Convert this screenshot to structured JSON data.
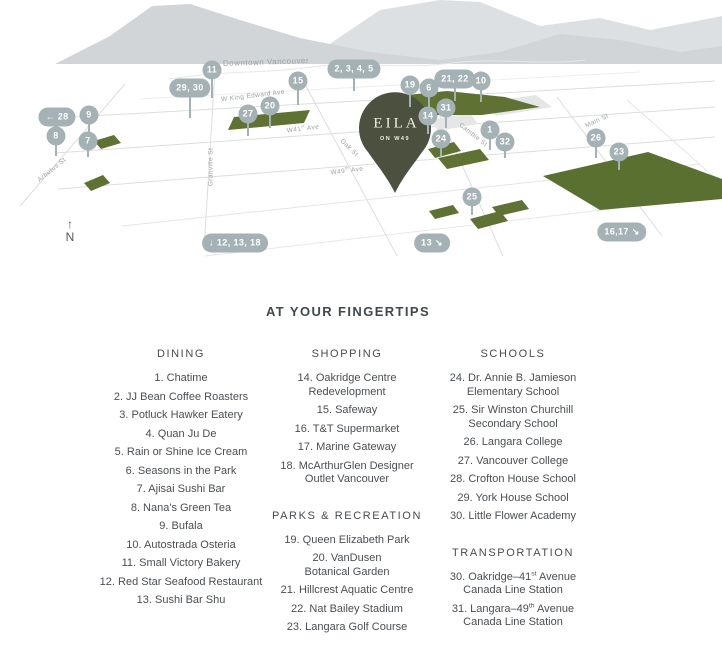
{
  "colors": {
    "marker": "#a4b2b6",
    "pin": "#4c503f",
    "pin_text": "#f0ede3",
    "park": "#5f7233",
    "golf": "#597031",
    "mountain": "#d1d5d7"
  },
  "map": {
    "pin": {
      "name": "EILA",
      "subtitle": "ON W49"
    },
    "north_arrow": "↑",
    "north_label": "N",
    "labels": [
      {
        "text": "Downtown Vancouver",
        "x": 266,
        "y": 62,
        "rot": -2,
        "big": true
      },
      {
        "text": "W King Edward Ave",
        "x": 253,
        "y": 96,
        "rot": -7
      },
      {
        "text": "W41st Ave",
        "x": 303,
        "y": 129,
        "rot": -7
      },
      {
        "text": "W49th Ave",
        "x": 347,
        "y": 171,
        "rot": -7
      },
      {
        "text": "Oak St",
        "x": 349,
        "y": 148,
        "rot": 44
      },
      {
        "text": "Cambie St",
        "x": 473,
        "y": 135,
        "rot": 38
      },
      {
        "text": "Main St",
        "x": 597,
        "y": 121,
        "rot": -26
      },
      {
        "text": "Granville St",
        "x": 211,
        "y": 167,
        "rot": -90
      },
      {
        "text": "Arbutus St",
        "x": 52,
        "y": 170,
        "rot": -39
      }
    ],
    "markers": [
      {
        "label": "11",
        "x": 212,
        "y": 70,
        "stem": 20
      },
      {
        "label": "29, 30",
        "x": 190,
        "y": 88,
        "stem": 22
      },
      {
        "label": "15",
        "x": 298,
        "y": 81,
        "stem": 16
      },
      {
        "label": "2, 3, 4, 5",
        "x": 354,
        "y": 69,
        "stem": 14
      },
      {
        "label": "19",
        "x": 410,
        "y": 85,
        "stem": 14
      },
      {
        "label": "6",
        "x": 429,
        "y": 88,
        "stem": 12
      },
      {
        "label": "21, 22",
        "x": 455,
        "y": 79,
        "stem": 14
      },
      {
        "label": "10",
        "x": 481,
        "y": 81,
        "stem": 13
      },
      {
        "label": "31",
        "x": 446,
        "y": 108,
        "stem": 12
      },
      {
        "label": "14",
        "x": 428,
        "y": 116,
        "stem": 10
      },
      {
        "label": "24",
        "x": 441,
        "y": 139,
        "stem": 9
      },
      {
        "label": "1",
        "x": 490,
        "y": 130,
        "stem": 12
      },
      {
        "label": "32",
        "x": 505,
        "y": 142,
        "stem": 8
      },
      {
        "label": "26",
        "x": 596,
        "y": 138,
        "stem": 12
      },
      {
        "label": "23",
        "x": 619,
        "y": 152,
        "stem": 10
      },
      {
        "label": "25",
        "x": 472,
        "y": 197,
        "stem": 10
      },
      {
        "label": "9",
        "x": 89,
        "y": 115,
        "stem": 12
      },
      {
        "label": "8",
        "x": 56,
        "y": 136,
        "stem": 12
      },
      {
        "label": "7",
        "x": 88,
        "y": 141,
        "stem": 8
      },
      {
        "label": "27",
        "x": 248,
        "y": 114,
        "stem": 14
      },
      {
        "label": "20",
        "x": 270,
        "y": 106,
        "stem": 14
      },
      {
        "label": "← 28",
        "x": 57,
        "y": 117,
        "stem": 0
      },
      {
        "label": "↓ 12, 13, 18",
        "x": 235,
        "y": 243,
        "stem": 0
      },
      {
        "label": "13 ↘",
        "x": 432,
        "y": 243,
        "stem": 0
      },
      {
        "label": "16,17 ↘",
        "x": 622,
        "y": 232,
        "stem": 0
      }
    ]
  },
  "legend": {
    "title": "AT YOUR FINGERTIPS",
    "columns": [
      {
        "sections": [
          {
            "title": "DINING",
            "items": [
              [
                "1.",
                "Chatime"
              ],
              [
                "2.",
                "JJ Bean Coffee Roasters"
              ],
              [
                "3.",
                "Potluck Hawker Eatery"
              ],
              [
                "4.",
                "Quan Ju De"
              ],
              [
                "5.",
                "Rain or Shine Ice Cream"
              ],
              [
                "6.",
                "Seasons in the Park"
              ],
              [
                "7.",
                "Ajisai Sushi Bar"
              ],
              [
                "8.",
                "Nana's Green Tea"
              ],
              [
                "9.",
                "Bufala"
              ],
              [
                "10.",
                "Autostrada Osteria"
              ],
              [
                "11.",
                "Small Victory Bakery"
              ],
              [
                "12.",
                "Red Star Seafood Restaurant"
              ],
              [
                "13.",
                "Sushi Bar Shu"
              ]
            ]
          }
        ]
      },
      {
        "sections": [
          {
            "title": "SHOPPING",
            "items": [
              [
                "14.",
                "Oakridge Centre\nRedevelopment"
              ],
              [
                "15.",
                "Safeway"
              ],
              [
                "16.",
                "T&T Supermarket"
              ],
              [
                "17.",
                "Marine Gateway"
              ],
              [
                "18.",
                "McArthurGlen Designer\nOutlet Vancouver"
              ]
            ]
          },
          {
            "title": "PARKS & RECREATION",
            "items": [
              [
                "19.",
                "Queen Elizabeth Park"
              ],
              [
                "20.",
                "VanDusen\nBotanical Garden"
              ],
              [
                "21.",
                "Hillcrest Aquatic Centre"
              ],
              [
                "22.",
                "Nat Bailey Stadium"
              ],
              [
                "23.",
                "Langara Golf Course"
              ]
            ]
          }
        ]
      },
      {
        "sections": [
          {
            "title": "SCHOOLS",
            "items": [
              [
                "24.",
                "Dr. Annie B. Jamieson\nElementary School"
              ],
              [
                "25.",
                "Sir Winston Churchill\nSecondary School"
              ],
              [
                "26.",
                "Langara College"
              ],
              [
                "27.",
                "Vancouver College"
              ],
              [
                "28.",
                "Crofton House School"
              ],
              [
                "29.",
                "York House School"
              ],
              [
                "30.",
                "Little Flower Academy"
              ]
            ]
          },
          {
            "title": "TRANSPORTATION",
            "items": [
              [
                "30.",
                "Oakridge–41st Avenue\nCanada Line Station"
              ],
              [
                "31.",
                "Langara–49th Avenue\nCanada Line Station"
              ]
            ]
          }
        ]
      }
    ]
  }
}
